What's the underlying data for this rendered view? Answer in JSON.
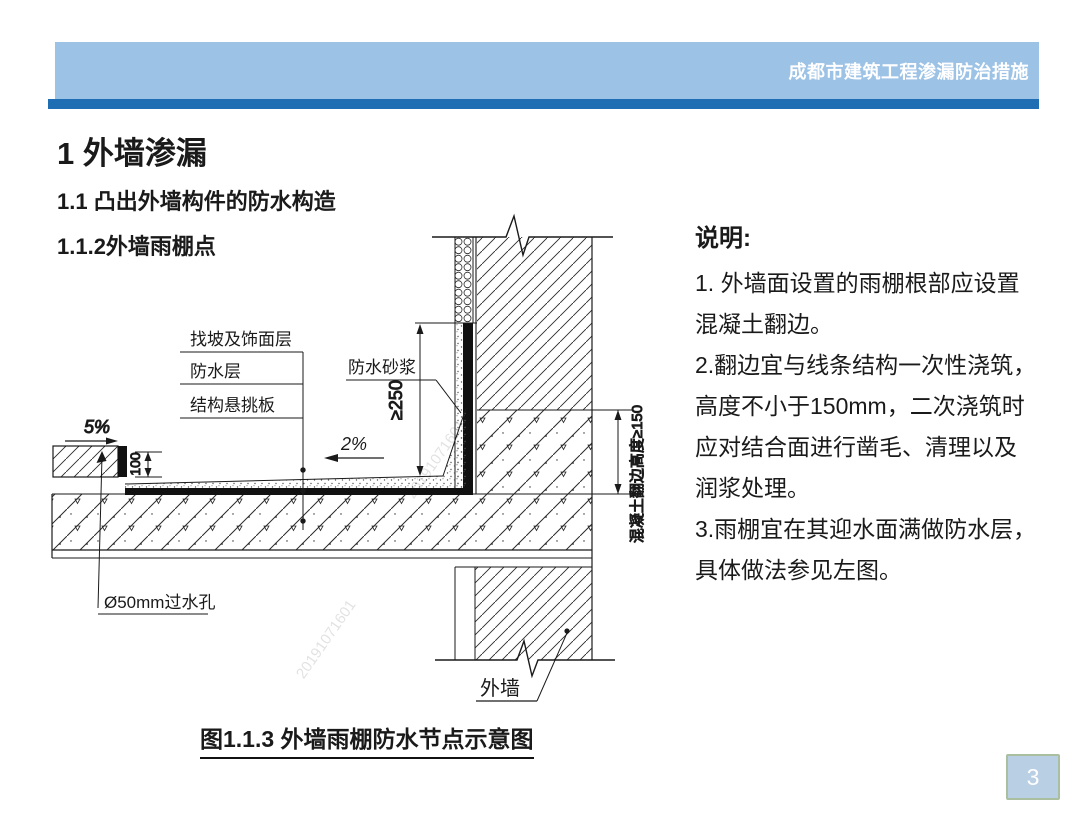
{
  "header": {
    "title": "成都市建筑工程渗漏防治措施"
  },
  "headings": {
    "h1": "1 外墙渗漏",
    "h2": "1.1 凸出外墙构件的防水构造",
    "h3": "1.1.2外墙雨棚点"
  },
  "notes": {
    "title": "说明:",
    "lines": [
      "1. 外墙面设置的雨棚根部应设置",
      "混凝土翻边。",
      "2.翻边宜与线条结构一次性浇筑，",
      "高度不小于150mm，二次浇筑时",
      "应对结合面进行凿毛、清理以及",
      "润浆处理。",
      "3.雨棚宜在其迎水面满做防水层，",
      "具体做法参见左图。"
    ]
  },
  "diagram": {
    "caption": "图1.1.3 外墙雨棚防水节点示意图",
    "labels": {
      "slope_drip": "5%",
      "dim_height_100": "100",
      "layer_screed": "找坡及饰面层",
      "layer_waterproof": "防水层",
      "layer_slab": "结构悬挑板",
      "waterproof_mortar": "防水砂浆",
      "slope_canopy": "2%",
      "dim_upstand_250": "≥250",
      "weep_hole": "Ø50mm过水孔",
      "dim_concrete_upturn": "混凝土翻边高度≥150",
      "exterior_wall": "外墙"
    },
    "watermark": "20191071601"
  },
  "footer": {
    "page_number": "3"
  },
  "colors": {
    "header_bar": "#9cc2e5",
    "header_stripe": "#1f6eb4",
    "page_badge_bg": "#b9cfe4",
    "page_badge_border": "#a9bfa0",
    "line_color": "#1a1a1a"
  }
}
